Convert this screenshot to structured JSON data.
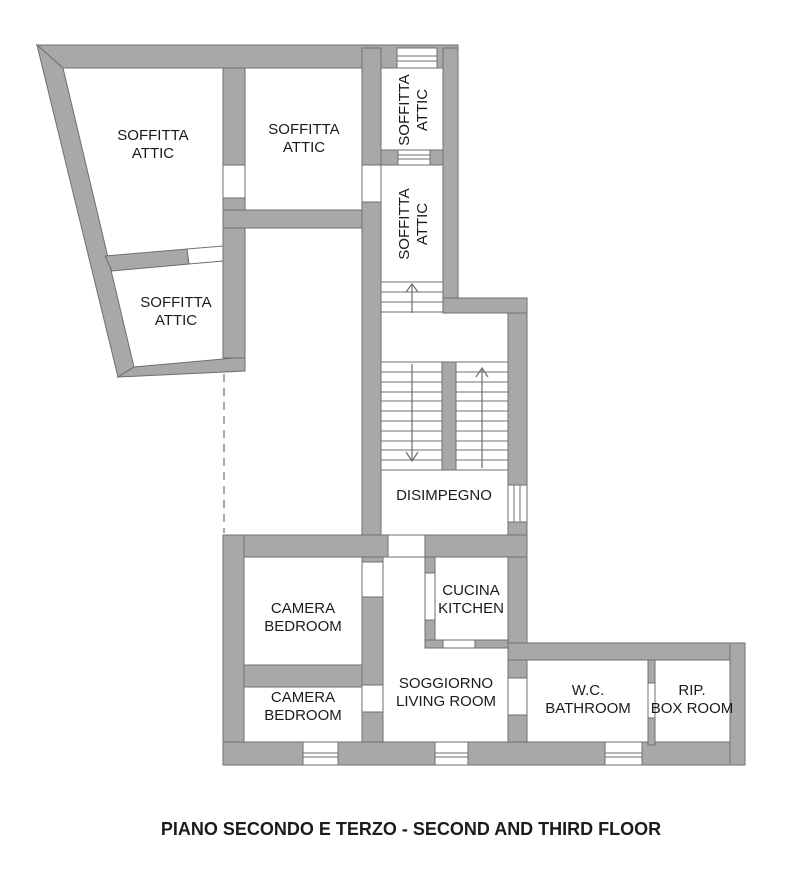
{
  "title": {
    "text": "PIANO SECONDO E TERZO - SECOND AND THIRD FLOOR"
  },
  "rooms": {
    "soffitta_large": {
      "line1": "SOFFITTA",
      "line2": "ATTIC"
    },
    "soffitta_mid": {
      "line1": "SOFFITTA",
      "line2": "ATTIC"
    },
    "soffitta_small": {
      "line1": "SOFFITTA",
      "line2": "ATTIC"
    },
    "soffitta_vertical_upper": {
      "line1": "SOFFITTA",
      "line2": "ATTIC"
    },
    "soffitta_vertical_lower": {
      "line1": "SOFFITTA",
      "line2": "ATTIC"
    },
    "disimpegno": {
      "line1": "DISIMPEGNO"
    },
    "camera_1": {
      "line1": "CAMERA",
      "line2": "BEDROOM"
    },
    "camera_2": {
      "line1": "CAMERA",
      "line2": "BEDROOM"
    },
    "cucina": {
      "line1": "CUCINA",
      "line2": "KITCHEN"
    },
    "soggiorno": {
      "line1": "SOGGIORNO",
      "line2": "LIVING ROOM"
    },
    "wc": {
      "line1": "W.C.",
      "line2": "BATHROOM"
    },
    "rip": {
      "line1": "RIP.",
      "line2": "BOX ROOM"
    }
  },
  "colors": {
    "wall_fill": "#a8a8a8",
    "wall_outline": "#6f6f6f",
    "text": "#1b1b1b",
    "background": "#ffffff"
  }
}
